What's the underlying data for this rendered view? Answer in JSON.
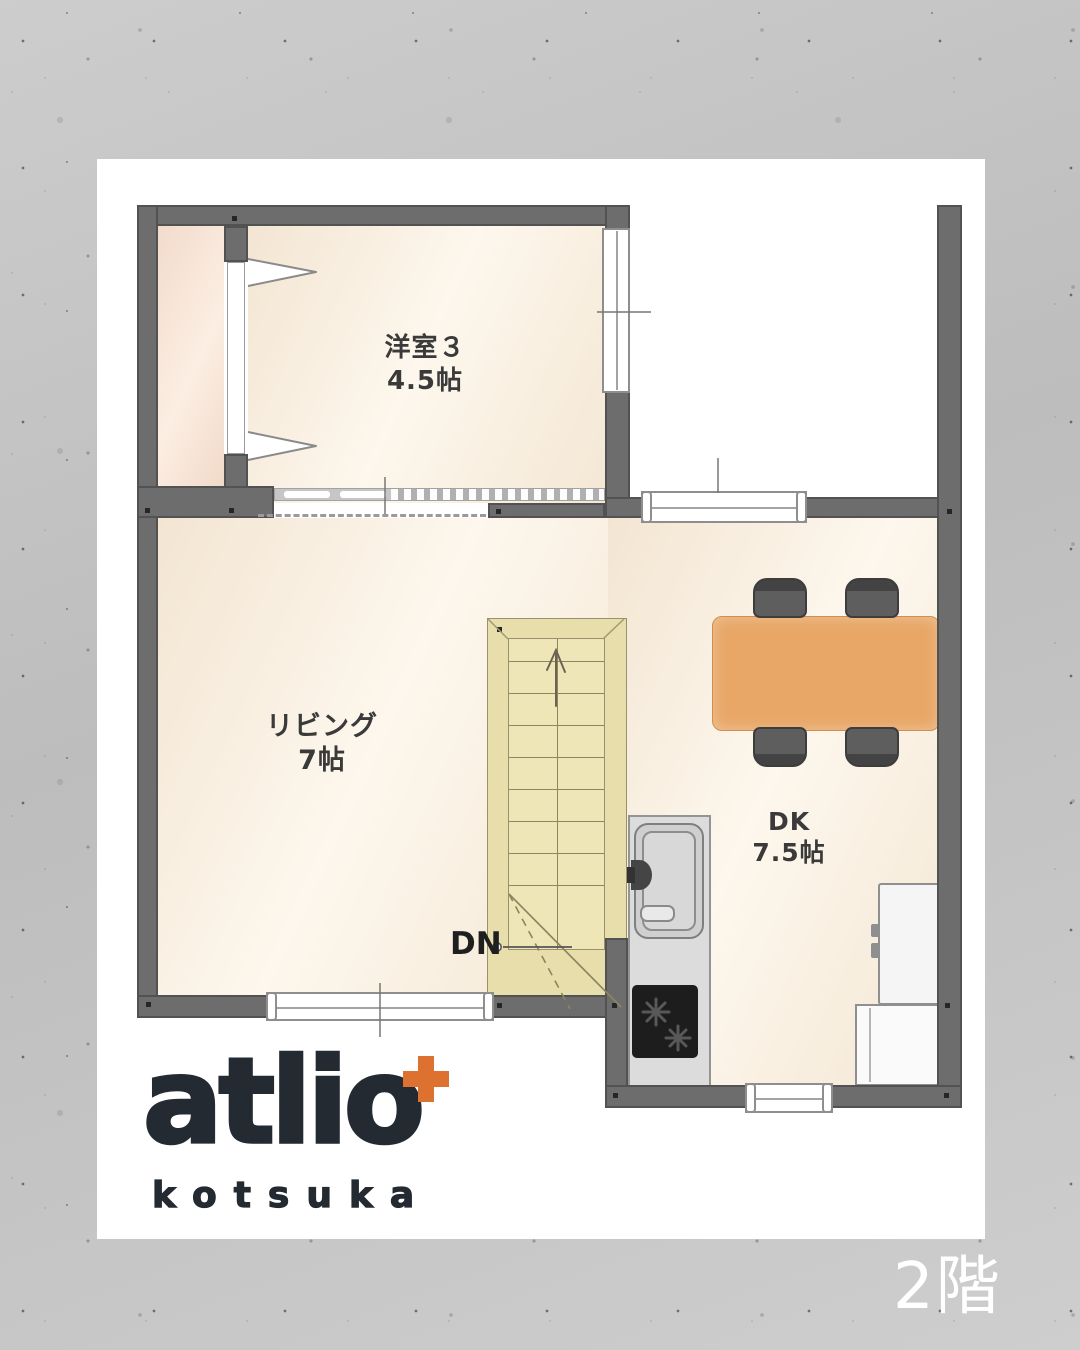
{
  "floor_badge": "2階",
  "logo": {
    "brand": "atlio",
    "tagline": "kotsuka",
    "plus_icon": "+"
  },
  "rooms": {
    "western3": {
      "name": "洋室３",
      "size": "4.5帖"
    },
    "living": {
      "name": "リビング",
      "size": "7帖"
    },
    "dk": {
      "name": "DK",
      "size": "7.5帖"
    }
  },
  "stairs": {
    "down_label": "DN"
  },
  "colors": {
    "accent-orange": "#dd7130",
    "logo-dark": "#232a31",
    "wall-gray": "#6d6d6d",
    "wall-edge": "#525252",
    "floor-cream": "#f6ead8",
    "closet-pink": "#f2dbcb",
    "stair-yellow": "#e8deab",
    "stair-light": "#efe6b8",
    "table-orange": "#e8a767",
    "text-dark": "#3a3a3a",
    "bg-concrete": "#c7c7c7"
  }
}
